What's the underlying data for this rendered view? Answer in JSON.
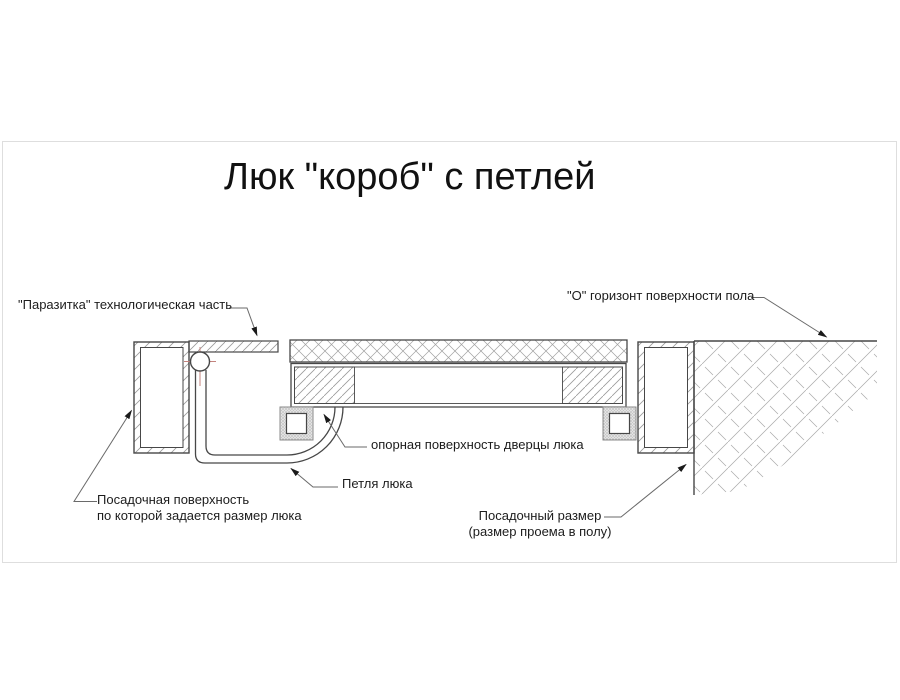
{
  "title": "Люк \"короб\" с петлей",
  "labels": {
    "parasitka": "\"Паразитка\" технологическая часть",
    "floor_horizon": "\"О\" горизонт поверхности пола",
    "bearing_surface": "опорная поверхность дверцы люка",
    "hinge": "Петля люка",
    "seating_surface_line1": "Посадочная поверхность",
    "seating_surface_line2": "по которой задается размер люка",
    "seating_size_line1": "Посадочный размер",
    "seating_size_line2": "(размер проема в полу)"
  },
  "colors": {
    "drawing_line": "#474747",
    "hatch_line": "#a0a0a0",
    "leader_line": "#6a6a6a",
    "text": "#1c1c1c",
    "crosshair_red": "#c4837d",
    "background": "#ffffff"
  }
}
